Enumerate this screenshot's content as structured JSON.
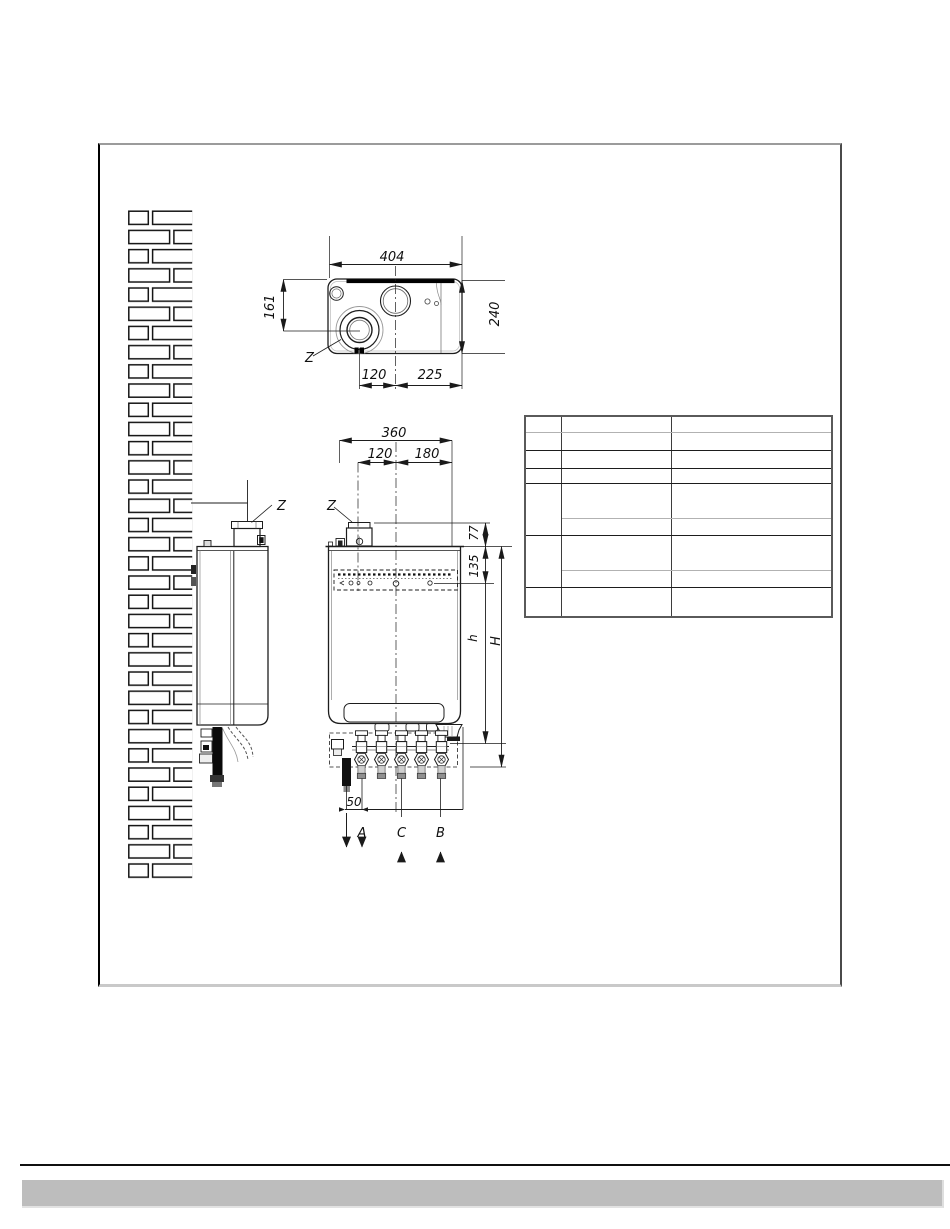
{
  "colors": {
    "line": "#1a1a1a",
    "footer_bar": "#bdbdbd",
    "frame_left_border": "#000000",
    "frame_top_border": "#9b9b9b"
  },
  "diagram": {
    "top_view": {
      "dim_width": "404",
      "dim_depth": "240",
      "dim_flue_vertical": "161",
      "dim_flue_offset": "120",
      "dim_center_to_edge": "225",
      "flue_label": "Z"
    },
    "side_view": {
      "flue_label": "Z"
    },
    "front_view": {
      "dim_width": "360",
      "dim_flue_offset": "120",
      "dim_flue_to_center": "180",
      "dim_flue_collar_height": "77",
      "dim_bracket_offset": "135",
      "dim_height_casing": "h",
      "dim_height_overall": "H",
      "dim_gas_offset": "50",
      "flue_label": "Z",
      "connections": {
        "a": "A",
        "c": "C",
        "b": "B"
      }
    }
  }
}
